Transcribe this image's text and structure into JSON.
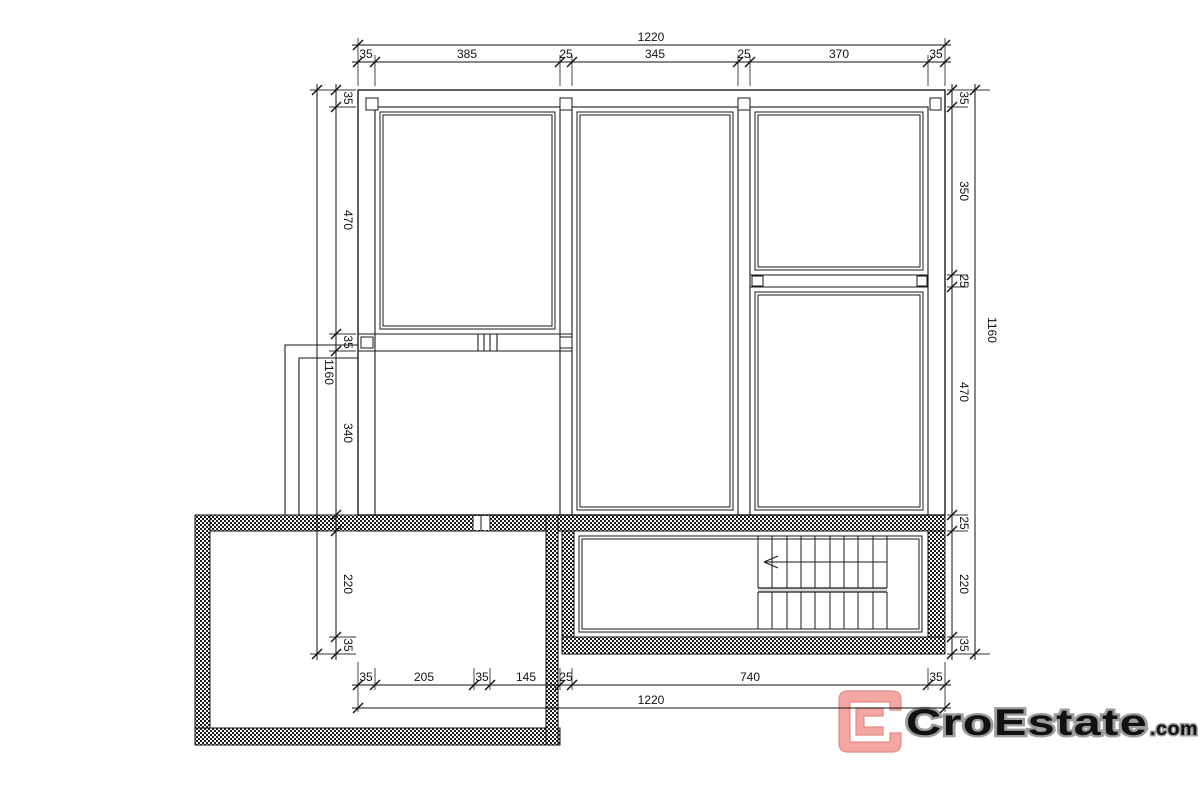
{
  "drawing": {
    "type": "floor-plan",
    "wall_fill": "crosshatch",
    "line_color": "#1a1a1a"
  },
  "dims": {
    "top_overall": "1220",
    "top": [
      "35",
      "385",
      "25",
      "345",
      "25",
      "370",
      "35"
    ],
    "left_overall": "1160",
    "left": [
      "35",
      "470",
      "35",
      "340",
      "220",
      "35"
    ],
    "right_overall": "1160",
    "right": [
      "35",
      "350",
      "25",
      "470",
      "25",
      "220",
      "35"
    ],
    "bottom_overall": "1220",
    "bottom": [
      "35",
      "205",
      "35",
      "145",
      "25",
      "740",
      "35"
    ]
  },
  "logo": {
    "brand": "CroEstate",
    "tld": ".com",
    "mark_fill": "#F3A6A2",
    "mark_stroke": "#E18B85",
    "text_fill": "#FFFFFF",
    "text_stroke": "#9C9C9C"
  }
}
